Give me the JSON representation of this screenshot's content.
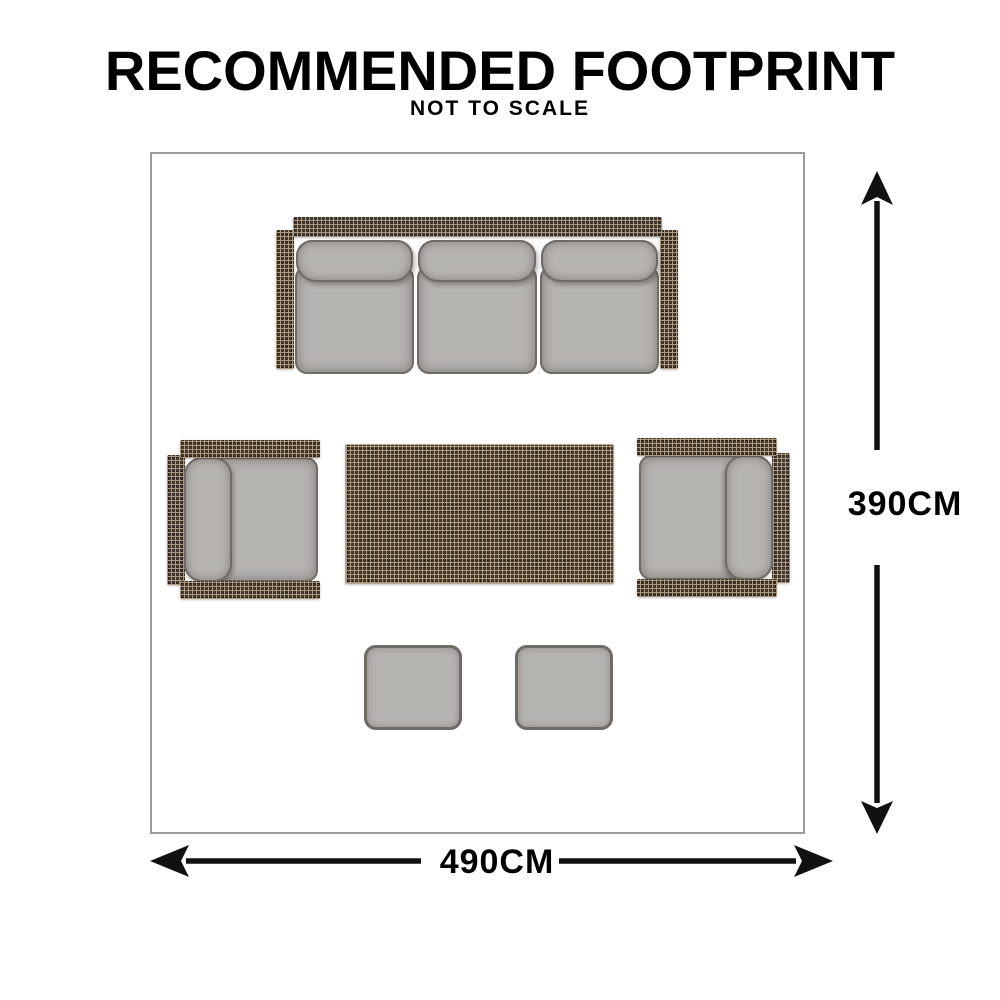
{
  "header": {
    "title": "RECOMMENDED FOOTPRINT",
    "subtitle": "NOT TO SCALE"
  },
  "diagram": {
    "height_label": "390CM",
    "width_label": "490CM",
    "furniture": {
      "sofa": "three-seat-sofa-top-view",
      "armchair_left": "armchair-top-view-facing-right",
      "armchair_right": "armchair-top-view-facing-left",
      "coffee_table": "rattan-coffee-table-top-view",
      "ottoman_left": "ottoman-top-view",
      "ottoman_right": "ottoman-top-view"
    }
  },
  "colors": {
    "text": "#000000",
    "room-border": "#9a9a9a",
    "wicker-base": "#42352b",
    "wicker-line": "#ab9a82",
    "cushion-fill": "#b6b4b1",
    "cushion-edge": "#6f6b67",
    "arrow": "#111111"
  }
}
